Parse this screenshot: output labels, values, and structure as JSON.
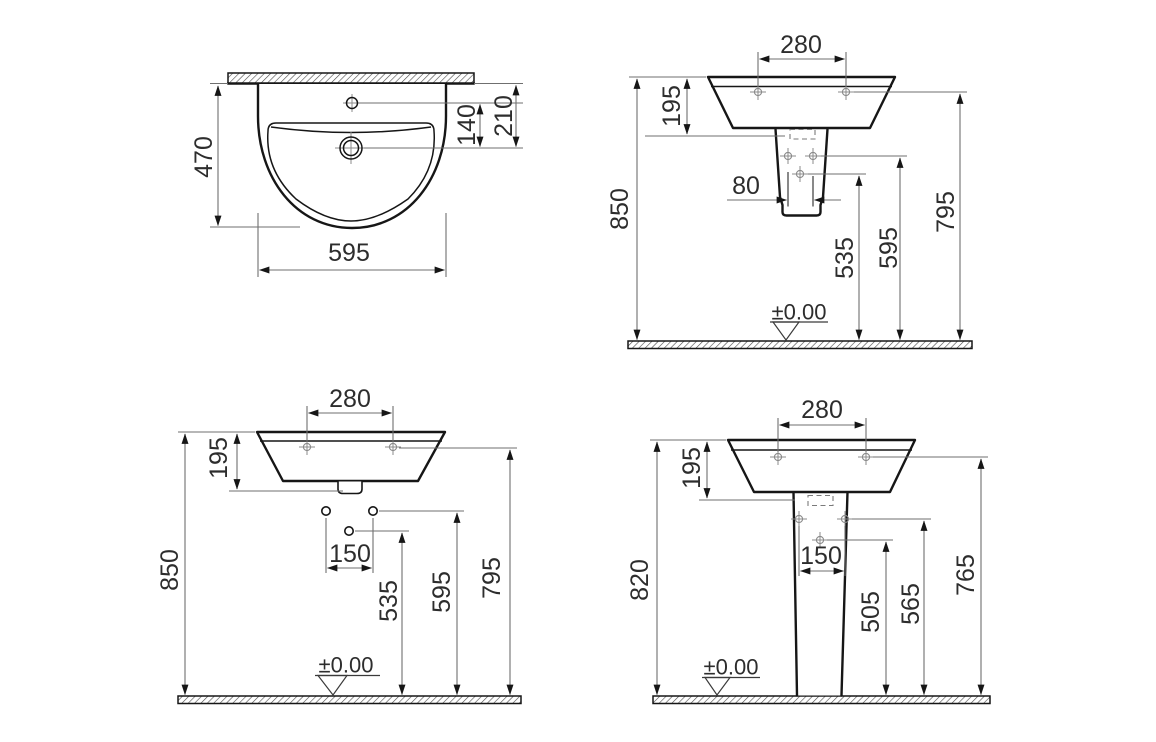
{
  "drawing": {
    "subject": "washbasin technical dimension drawing",
    "views": {
      "plan": {
        "depth": "470",
        "width": "595",
        "tap_to_drain": "140",
        "wall_to_drain": "210"
      },
      "semi": {
        "hole_spacing": "280",
        "rim_height": "195",
        "overall_height": "850",
        "outlet_width": "80",
        "h1": "535",
        "h2": "595",
        "h3": "795",
        "datum": "±0.00"
      },
      "wall": {
        "hole_spacing": "280",
        "rim_height": "195",
        "overall_height": "850",
        "fixing_spacing": "150",
        "h1": "535",
        "h2": "595",
        "h3": "795",
        "datum": "±0.00"
      },
      "pedestal": {
        "hole_spacing": "280",
        "rim_height": "195",
        "overall_height": "820",
        "fixing_spacing": "150",
        "h1": "505",
        "h2": "565",
        "h3": "765",
        "datum": "±0.00"
      }
    }
  }
}
